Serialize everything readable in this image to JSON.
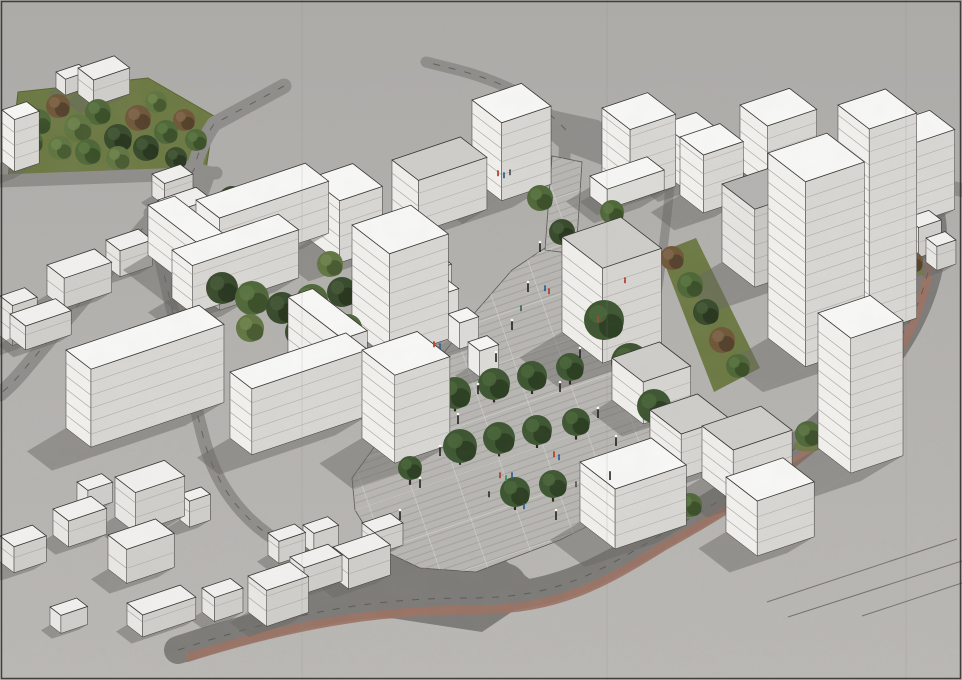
{
  "meta": {
    "alt": "Aerial axonometric 3D massing render of a proposed urban district: white new-build blocks with tree-filled courtyards around a tree-lined pedestrian boulevard with people and lamp posts, a park at the upper left, low existing houses at the lower left, and roads with a red cycle lane curving around the site"
  },
  "scene": {
    "canvas": {
      "w": 962,
      "h": 680
    },
    "colors": {
      "ground_top": "#adabA8",
      "ground_bottom": "#bab8b4",
      "road": "#8f8d8a",
      "road_dark": "#7d7b78",
      "road_edge": "#57554f",
      "dash": "#4e4c48",
      "lane_red": "#9a7264",
      "plaza": "#b8b6b2",
      "paving_line": "#a09e9a",
      "paving_joint": "#d7d5d1",
      "lawn": "#6c7943",
      "lawn_dark": "#57652f",
      "shadow": "#696763",
      "outline": "#35332f",
      "floor_line": "#96948f",
      "frame": "#2b2a28",
      "seam": "#8a8885",
      "lamp_post": "#1f1e1c",
      "lamp_glow": "#fffdf2",
      "trunk": "#2e2518",
      "tree": {
        "g1": [
          "#4e6737",
          "#394f27",
          "#5d7742"
        ],
        "g2": [
          "#5f7540",
          "#46592e",
          "#6f844d"
        ],
        "dk": [
          "#36492a",
          "#27351d",
          "#455936"
        ],
        "br": [
          "#6f5638",
          "#54402a",
          "#81664a"
        ],
        "pl": [
          "#3c5530",
          "#2a3d20",
          "#4a6539"
        ]
      }
    },
    "styles": {
      "w": {
        "roof": "#f8f8f6",
        "face": "#f2f1ee",
        "side": "#d8d7d3",
        "lines": 13
      },
      "g": {
        "roof": "#cecdc9",
        "face": "#f0efec",
        "side": "#d6d5d1",
        "lines": 13
      },
      "d": {
        "roof": "#b4b3b0",
        "face": "#e6e5e2",
        "side": "#c9c8c4",
        "lines": 14
      },
      "c": {
        "roof": "#f2f1ef",
        "face": "#e9e8e5",
        "side": "#cfceca",
        "lines": 15
      },
      "k": {
        "roof": "#f7f7f5",
        "face": "#f0efed",
        "side": "#dcdbd8",
        "lines": 99
      }
    },
    "park": [
      18,
      92,
      148,
      78,
      214,
      116,
      206,
      170,
      8,
      178
    ],
    "lawns": [
      [
        660,
        252,
        696,
        238,
        760,
        368,
        714,
        392
      ]
    ],
    "roads": [
      {
        "d": "M284,86 L214,124 Q198,148 194,170 L143,228 L22,372 Q12,384 0,394",
        "w": 15,
        "dash": true
      },
      {
        "d": "M216,173 L0,181",
        "w": 13
      },
      {
        "d": "M150,213 C168,292 186,370 204,440 C220,500 262,546 336,566",
        "w": 13,
        "dash": true
      },
      {
        "d": "M178,650 C300,610 380,598 470,598 C560,598 602,570 662,534 C742,490 802,448 852,398 C902,348 926,298 932,250 C936,215 928,194 904,182 L868,170",
        "w": 28,
        "c": "road_dark",
        "dash": true
      },
      {
        "d": "M330,598 C400,574 452,572 504,586",
        "w": 46,
        "c": "road_dark"
      },
      {
        "d": "M868,170 L962,190",
        "w": 14
      },
      {
        "d": "M566,130 C538,100 504,82 458,70 L426,62",
        "w": 11,
        "dash": true
      },
      {
        "d": "M564,128 C602,134 644,150 672,164 C692,174 700,180 704,188",
        "w": 11
      },
      {
        "d": "M672,166 C666,230 658,298 646,358 C638,400 628,430 616,452",
        "w": 9
      },
      {
        "d": "M566,128 L564,164",
        "w": 12
      }
    ],
    "junctions": [
      {
        "pts": [
          552,
          110,
          598,
          120,
          644,
          146,
          610,
          168,
          562,
          150,
          544,
          134
        ],
        "c": "road"
      },
      {
        "pts": [
          336,
          558,
          420,
          542,
          502,
          558,
          544,
          590,
          482,
          632,
          378,
          616,
          330,
          584
        ],
        "c": "road_dark"
      },
      {
        "pts": [
          176,
          158,
          218,
          168,
          208,
          196,
          172,
          188
        ],
        "c": "road"
      }
    ],
    "lane": {
      "d": "M186,658 C306,620 388,610 474,610 C560,610 606,582 664,546 C744,502 804,460 854,410 C900,362 924,310 930,260 C934,226 926,206 902,194",
      "w": 9
    },
    "hatches": [
      [
        890,
        158,
        882,
        172
      ],
      [
        899,
        163,
        891,
        177
      ],
      [
        908,
        169,
        900,
        183
      ],
      [
        917,
        175,
        909,
        189
      ],
      [
        926,
        181,
        918,
        195
      ],
      [
        935,
        187,
        927,
        201
      ],
      [
        944,
        193,
        936,
        207
      ],
      [
        953,
        199,
        945,
        213
      ]
    ],
    "ground_lines": [
      [
        767,
        602,
        957,
        539
      ],
      [
        788,
        617,
        962,
        561
      ],
      [
        862,
        616,
        962,
        583
      ]
    ],
    "plaza": [
      545,
      248,
      575,
      252,
      598,
      310,
      625,
      372,
      665,
      432,
      706,
      466,
      640,
      500,
      560,
      540,
      476,
      572,
      420,
      568,
      378,
      548,
      355,
      510,
      352,
      478,
      398,
      414,
      434,
      366,
      472,
      316,
      512,
      270
    ],
    "stem": [
      545,
      250,
      576,
      254,
      582,
      162,
      552,
      156
    ],
    "buildings": [
      [
        196,
        252,
        115,
        30,
        52,
        "w"
      ],
      [
        148,
        255,
        28,
        92,
        50,
        "w"
      ],
      [
        172,
        298,
        112,
        26,
        48,
        "w"
      ],
      [
        66,
        428,
        140,
        32,
        78,
        "w"
      ],
      [
        230,
        438,
        122,
        28,
        66,
        "w"
      ],
      [
        288,
        352,
        26,
        70,
        55,
        "w"
      ],
      [
        310,
        240,
        45,
        38,
        62,
        "w"
      ],
      [
        352,
        330,
        62,
        48,
        105,
        "w"
      ],
      [
        362,
        438,
        58,
        42,
        88,
        "w"
      ],
      [
        428,
        312,
        20,
        15,
        26,
        "k"
      ],
      [
        448,
        340,
        20,
        15,
        26,
        "k"
      ],
      [
        468,
        368,
        20,
        15,
        26,
        "k"
      ],
      [
        388,
        300,
        52,
        18,
        30,
        "k"
      ],
      [
        392,
        212,
        72,
        34,
        52,
        "g"
      ],
      [
        472,
        178,
        52,
        38,
        78,
        "w"
      ],
      [
        602,
        180,
        48,
        36,
        72,
        "w"
      ],
      [
        590,
        196,
        60,
        22,
        20,
        "k"
      ],
      [
        562,
        332,
        62,
        52,
        95,
        "g"
      ],
      [
        612,
        400,
        50,
        40,
        42,
        "g"
      ],
      [
        650,
        455,
        50,
        40,
        45,
        "g"
      ],
      [
        580,
        522,
        75,
        45,
        60,
        "w"
      ],
      [
        680,
        195,
        42,
        30,
        58,
        "w"
      ],
      [
        662,
        172,
        36,
        26,
        48,
        "w"
      ],
      [
        722,
        262,
        55,
        42,
        78,
        "d"
      ],
      [
        768,
        338,
        62,
        48,
        185,
        "w"
      ],
      [
        838,
        310,
        50,
        40,
        205,
        "w"
      ],
      [
        818,
        448,
        55,
        42,
        135,
        "w"
      ],
      [
        740,
        170,
        52,
        35,
        65,
        "w"
      ],
      [
        886,
        205,
        46,
        32,
        80,
        "w"
      ],
      [
        702,
        478,
        62,
        40,
        52,
        "g"
      ],
      [
        726,
        532,
        60,
        40,
        55,
        "w"
      ],
      [
        906,
        248,
        24,
        16,
        30,
        "c"
      ],
      [
        926,
        262,
        20,
        14,
        24,
        "c"
      ],
      [
        106,
        266,
        34,
        18,
        26,
        "c"
      ],
      [
        47,
        295,
        50,
        22,
        30,
        "c"
      ],
      [
        10,
        338,
        48,
        20,
        24,
        "c"
      ],
      [
        152,
        196,
        30,
        16,
        22,
        "c"
      ],
      [
        158,
        228,
        40,
        20,
        28,
        "c"
      ],
      [
        78,
        94,
        38,
        20,
        26,
        "c"
      ],
      [
        56,
        88,
        24,
        12,
        16,
        "c"
      ],
      [
        2,
        162,
        26,
        16,
        52,
        "w"
      ],
      [
        0,
        336,
        26,
        16,
        40,
        "c"
      ],
      [
        115,
        517,
        52,
        26,
        40,
        "c"
      ],
      [
        77,
        502,
        26,
        14,
        20,
        "c"
      ],
      [
        53,
        535,
        40,
        20,
        26,
        "c"
      ],
      [
        108,
        569,
        50,
        24,
        34,
        "c"
      ],
      [
        180,
        520,
        22,
        12,
        26,
        "c"
      ],
      [
        202,
        612,
        30,
        16,
        24,
        "c"
      ],
      [
        127,
        625,
        56,
        20,
        22,
        "c"
      ],
      [
        248,
        612,
        44,
        24,
        36,
        "c"
      ],
      [
        268,
        555,
        28,
        14,
        22,
        "c"
      ],
      [
        303,
        545,
        26,
        14,
        20,
        "c"
      ],
      [
        50,
        625,
        28,
        14,
        18,
        "c"
      ],
      [
        0,
        562,
        34,
        18,
        26,
        "c"
      ],
      [
        290,
        583,
        40,
        18,
        26,
        "c"
      ],
      [
        333,
        577,
        44,
        20,
        30,
        "c"
      ],
      [
        362,
        545,
        30,
        16,
        22,
        "c"
      ]
    ],
    "trees": {
      "park": [
        [
          38,
          122,
          13,
          "g1"
        ],
        [
          58,
          106,
          12,
          "br"
        ],
        [
          78,
          128,
          14,
          "g2"
        ],
        [
          98,
          112,
          13,
          "g1"
        ],
        [
          118,
          138,
          14,
          "dk"
        ],
        [
          138,
          118,
          13,
          "br"
        ],
        [
          60,
          148,
          12,
          "g2"
        ],
        [
          88,
          152,
          13,
          "g1"
        ],
        [
          118,
          158,
          12,
          "g2"
        ],
        [
          146,
          148,
          13,
          "dk"
        ],
        [
          166,
          132,
          12,
          "g1"
        ],
        [
          184,
          120,
          11,
          "br"
        ],
        [
          32,
          142,
          11,
          "g1"
        ],
        [
          156,
          102,
          11,
          "g2"
        ],
        [
          196,
          140,
          11,
          "g1"
        ],
        [
          176,
          158,
          11,
          "dk"
        ]
      ],
      "courtyard": [
        [
          232,
          200,
          14,
          "dk"
        ],
        [
          256,
          208,
          15,
          "g1"
        ],
        [
          280,
          200,
          13,
          "dk"
        ],
        [
          302,
          212,
          13,
          "g1"
        ],
        [
          240,
          222,
          12,
          "g2"
        ],
        [
          222,
          288,
          16,
          "dk"
        ],
        [
          252,
          298,
          17,
          "g1"
        ],
        [
          282,
          308,
          16,
          "dk"
        ],
        [
          312,
          300,
          16,
          "g1"
        ],
        [
          342,
          292,
          15,
          "dk"
        ],
        [
          372,
          300,
          15,
          "g1"
        ],
        [
          400,
          310,
          14,
          "dk"
        ],
        [
          250,
          328,
          14,
          "g2"
        ],
        [
          300,
          332,
          15,
          "dk"
        ],
        [
          348,
          328,
          14,
          "g1"
        ],
        [
          388,
          330,
          13,
          "dk"
        ],
        [
          232,
          264,
          13,
          "g1"
        ],
        [
          280,
          268,
          14,
          "dk"
        ],
        [
          330,
          264,
          13,
          "g2"
        ],
        [
          378,
          268,
          13,
          "br"
        ],
        [
          262,
          398,
          13,
          "dk"
        ],
        [
          298,
          408,
          14,
          "g1"
        ],
        [
          336,
          404,
          13,
          "dk"
        ],
        [
          372,
          400,
          12,
          "g2"
        ]
      ],
      "strip": [
        [
          672,
          258,
          12,
          "br"
        ],
        [
          690,
          285,
          13,
          "g1"
        ],
        [
          706,
          312,
          13,
          "dk"
        ],
        [
          722,
          340,
          13,
          "br"
        ],
        [
          738,
          366,
          12,
          "g1"
        ]
      ],
      "scatter": [
        [
          540,
          198,
          13,
          "g1"
        ],
        [
          562,
          232,
          13,
          "dk"
        ],
        [
          588,
          252,
          12,
          "br"
        ],
        [
          612,
          212,
          12,
          "g1"
        ],
        [
          452,
          162,
          11,
          "g2"
        ],
        [
          655,
          468,
          12,
          "dk"
        ],
        [
          690,
          505,
          12,
          "g1"
        ]
      ],
      "street": [
        [
          900,
          295,
          12,
          "g1"
        ],
        [
          880,
          330,
          13,
          "g2"
        ],
        [
          858,
          365,
          13,
          "g1"
        ],
        [
          834,
          400,
          13,
          "dk"
        ],
        [
          808,
          434,
          13,
          "g1"
        ],
        [
          780,
          462,
          12,
          "g2"
        ],
        [
          912,
          262,
          11,
          "br"
        ],
        [
          905,
          282,
          11,
          "g2"
        ]
      ],
      "plaza": [
        [
          455,
          393,
          16
        ],
        [
          494,
          384,
          16
        ],
        [
          532,
          376,
          15
        ],
        [
          570,
          367,
          14
        ],
        [
          460,
          446,
          17
        ],
        [
          499,
          438,
          16
        ],
        [
          537,
          430,
          15
        ],
        [
          576,
          422,
          14
        ],
        [
          515,
          492,
          15
        ],
        [
          553,
          484,
          14
        ],
        [
          604,
          320,
          20
        ],
        [
          630,
          362,
          19
        ],
        [
          654,
          406,
          17
        ],
        [
          420,
          425,
          12
        ],
        [
          410,
          468,
          12
        ]
      ]
    },
    "lamps": [
      [
        540,
        252
      ],
      [
        528,
        292
      ],
      [
        512,
        330
      ],
      [
        496,
        362
      ],
      [
        478,
        394
      ],
      [
        458,
        424
      ],
      [
        440,
        456
      ],
      [
        420,
        488
      ],
      [
        400,
        520
      ],
      [
        560,
        392
      ],
      [
        580,
        358
      ],
      [
        598,
        418
      ],
      [
        616,
        446
      ],
      [
        556,
        520
      ],
      [
        610,
        480
      ]
    ],
    "people": [
      [
        498,
        176,
        "#b3402e"
      ],
      [
        504,
        178,
        "#2e5f93"
      ],
      [
        510,
        175,
        "#555555"
      ],
      [
        545,
        291,
        "#2e5f93"
      ],
      [
        549,
        294,
        "#b3402e"
      ],
      [
        521,
        311,
        "#3d6b4f"
      ],
      [
        434,
        347,
        "#b3402e"
      ],
      [
        440,
        349,
        "#2e5f93"
      ],
      [
        554,
        457,
        "#b3402e"
      ],
      [
        559,
        460,
        "#2e5f93"
      ],
      [
        500,
        478,
        "#b3402e"
      ],
      [
        506,
        481,
        "#3f8f5a"
      ],
      [
        512,
        478,
        "#2e5f93"
      ],
      [
        489,
        497,
        "#333333"
      ],
      [
        524,
        509,
        "#2e5f93"
      ],
      [
        576,
        487,
        "#555555"
      ],
      [
        625,
        283,
        "#b3402e"
      ],
      [
        598,
        322,
        "#b3402e"
      ]
    ],
    "seams": [
      302,
      607,
      906
    ]
  }
}
